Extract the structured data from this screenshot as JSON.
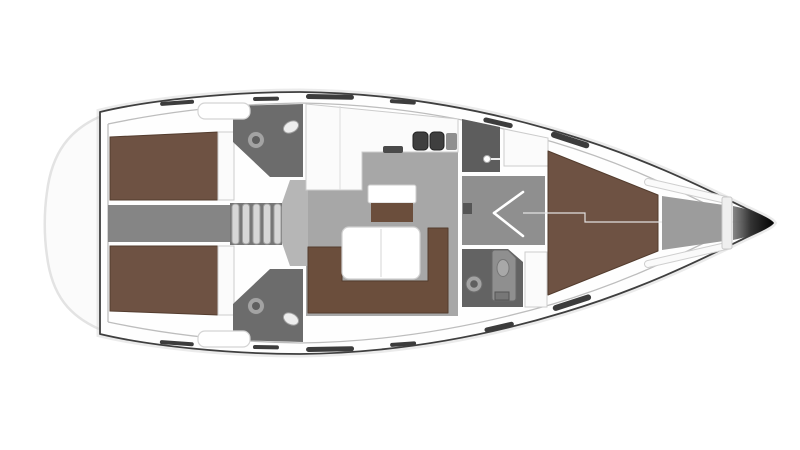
{
  "scene": {
    "type": "yacht-deck-plan",
    "view": "top-down",
    "bow_direction": "right"
  },
  "rooms": [
    {
      "name": "aft-cabin-port"
    },
    {
      "name": "aft-cabin-starboard"
    },
    {
      "name": "aft-head-port"
    },
    {
      "name": "aft-head-starboard"
    },
    {
      "name": "companionway"
    },
    {
      "name": "saloon"
    },
    {
      "name": "galley"
    },
    {
      "name": "shower-room"
    },
    {
      "name": "forward-head"
    },
    {
      "name": "forward-cabin"
    },
    {
      "name": "anchor-locker"
    }
  ],
  "fixtures": [
    "companionway-steps",
    "double-berth",
    "u-shaped-sofa",
    "saloon-table",
    "sideboard",
    "double-sink",
    "stove",
    "toilet",
    "washbasin",
    "shower-head",
    "v-berth",
    "cabin-door",
    "deck-hatch",
    "hull-window"
  ],
  "colors": {
    "canvas": "#ffffff",
    "hull_line": "#3f3f3f",
    "hull_shadow": "#c7c7c7",
    "deck": "#fefefe",
    "transom_halo": "#fbfbfb",
    "berth": "#6e5243",
    "berth_edge": "#533c2e",
    "sofa": "#6b4e3c",
    "salon_floor": "#a7a7a7",
    "landing_floor": "#b6b6b6",
    "aft_corridor": "#858585",
    "fwd_corridor": "#8f8f8f",
    "wetroom": "#6c6c6c",
    "shower": "#5d5d5d",
    "fwd_head": "#636363",
    "locker": "#9c9c9c",
    "steps": "#d6d6d6",
    "steps_well": "#767676",
    "counter": "#fbfbfb",
    "table": "#ffffff",
    "sink_basin": "#3f3f3f",
    "fixture": "#8f8f8f",
    "porcelain": "#ededed",
    "toilet_ring": "#a3a3a3",
    "toilet_bowl": "#5f5f5f",
    "window_slit": "#3c3c3c",
    "bow_start": "#7a7a7a",
    "bow_mid": "#333333",
    "bow_tip": "#000000"
  }
}
